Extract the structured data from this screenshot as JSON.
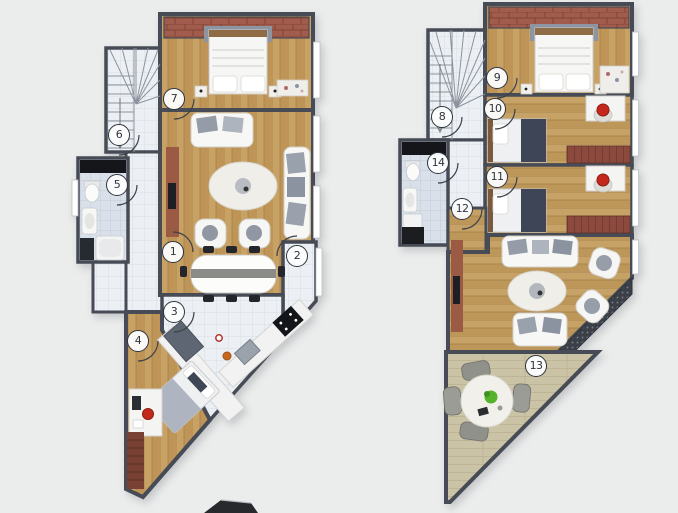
{
  "plans": [
    {
      "name": "lower-floor",
      "markers": [
        {
          "label": "1"
        },
        {
          "label": "2"
        },
        {
          "label": "3"
        },
        {
          "label": "4"
        },
        {
          "label": "5"
        },
        {
          "label": "6"
        },
        {
          "label": "7"
        }
      ]
    },
    {
      "name": "upper-floor",
      "markers": [
        {
          "label": "8"
        },
        {
          "label": "9"
        },
        {
          "label": "10"
        },
        {
          "label": "11"
        },
        {
          "label": "12"
        },
        {
          "label": "13"
        },
        {
          "label": "14"
        }
      ]
    }
  ],
  "colors": {
    "background": "#ebecec",
    "wall": "#464b55",
    "wood_floor": "#c8a164",
    "tile_floor": "#ecf0f4",
    "bathroom_tile": "#d9e0e9",
    "brick_terrace": "#a25c4d",
    "bench_brick": "#8c4a3e",
    "deck_terrace": "#cbc3a6",
    "railing": "#3a3f48",
    "tv_console_wood": "#9a5a44",
    "bed_navy": "#3e4557",
    "accent_chair_red": "#c4281c",
    "plant_green": "#55b32d",
    "furniture_white": "#f6f6f4",
    "marker_ring": "#2f343d"
  }
}
